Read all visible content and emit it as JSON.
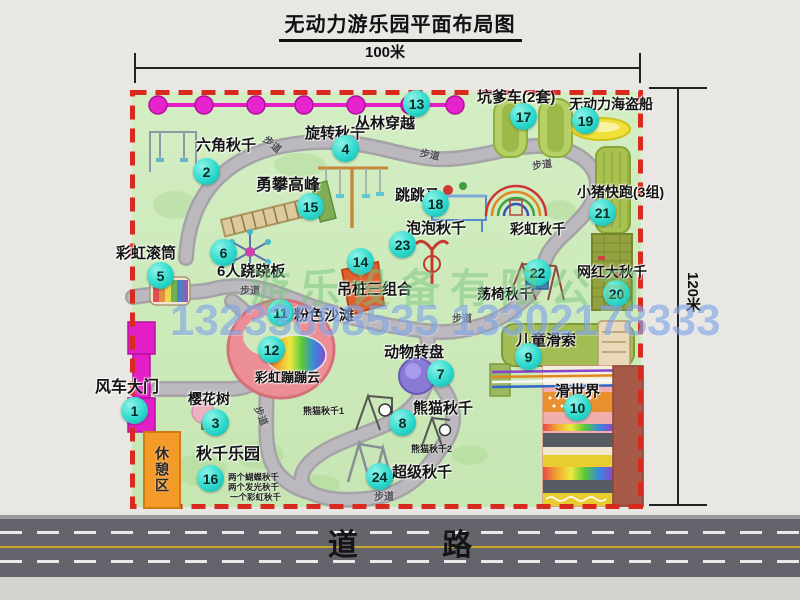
{
  "title": "无动力游乐园平面布局图",
  "dimensions": {
    "width": "100米",
    "height": "120米"
  },
  "road_label": "道 路",
  "watermark": {
    "company": "游乐设备有限公司",
    "phones": "13233808535 13302178333"
  },
  "rest_area_label": "休憩区",
  "rainbow_swing_label": "彩虹秋千",
  "panda_swing_sub1": "熊猫秋千1",
  "panda_swing_sub2": "熊猫秋千2",
  "swing_park_notes": [
    "两个蝴蝶秋千",
    "两个发光秋千",
    "一个彩虹秋千"
  ],
  "path_label": "步道",
  "path_labels": [
    {
      "x": 263,
      "y": 136,
      "rot": 40
    },
    {
      "x": 420,
      "y": 146,
      "rot": 12
    },
    {
      "x": 532,
      "y": 156,
      "rot": -8
    },
    {
      "x": 240,
      "y": 282,
      "rot": 0
    },
    {
      "x": 452,
      "y": 310,
      "rot": 0
    },
    {
      "x": 252,
      "y": 408,
      "rot": 68
    },
    {
      "x": 374,
      "y": 488,
      "rot": 0
    }
  ],
  "attractions": [
    {
      "num": "1",
      "label": "风车大门",
      "badge": [
        135,
        411
      ],
      "label_pos": [
        95,
        380
      ],
      "size": 16
    },
    {
      "num": "2",
      "label": "六角秋千",
      "badge": [
        207,
        172
      ],
      "label_pos": [
        196,
        138
      ],
      "size": 15
    },
    {
      "num": "3",
      "label": "樱花树",
      "badge": [
        216,
        423
      ],
      "label_pos": [
        188,
        392
      ],
      "size": 14
    },
    {
      "num": "4",
      "label": "旋转秋千",
      "badge": [
        346,
        149
      ],
      "label_pos": [
        305,
        126
      ],
      "size": 15
    },
    {
      "num": "5",
      "label": "彩虹滚筒",
      "badge": [
        161,
        276
      ],
      "label_pos": [
        116,
        246
      ],
      "size": 15
    },
    {
      "num": "6",
      "label": "6人跷跷板",
      "badge": [
        224,
        253
      ],
      "label_pos": [
        217,
        264
      ],
      "size": 15
    },
    {
      "num": "7",
      "label": "动物转盘",
      "badge": [
        441,
        374
      ],
      "label_pos": [
        384,
        345
      ],
      "size": 15
    },
    {
      "num": "8",
      "label": "熊猫秋千",
      "badge": [
        403,
        423
      ],
      "label_pos": [
        413,
        401
      ],
      "size": 15
    },
    {
      "num": "9",
      "label": "儿童滑索",
      "badge": [
        529,
        357
      ],
      "label_pos": [
        516,
        333
      ],
      "size": 15
    },
    {
      "num": "10",
      "label": "滑世界",
      "badge": [
        578,
        408
      ],
      "label_pos": [
        555,
        384
      ],
      "size": 15
    },
    {
      "num": "11",
      "label": "粉色沙滩",
      "badge": [
        281,
        313
      ],
      "label_pos": [
        294,
        308
      ],
      "size": 15
    },
    {
      "num": "12",
      "label": "彩虹蹦蹦云",
      "badge": [
        272,
        350
      ],
      "label_pos": [
        255,
        371
      ],
      "size": 13
    },
    {
      "num": "13",
      "label": "丛林穿越",
      "badge": [
        417,
        104
      ],
      "label_pos": [
        355,
        116
      ],
      "size": 15
    },
    {
      "num": "14",
      "label": "吊桩三组合",
      "badge": [
        361,
        262
      ],
      "label_pos": [
        337,
        282
      ],
      "size": 15
    },
    {
      "num": "15",
      "label": "勇攀高峰",
      "badge": [
        311,
        207
      ],
      "label_pos": [
        256,
        178
      ],
      "size": 16
    },
    {
      "num": "16",
      "label": "秋千乐园",
      "badge": [
        211,
        479
      ],
      "label_pos": [
        196,
        447
      ],
      "size": 16
    },
    {
      "num": "17",
      "label": "坑爹车(2套)",
      "badge": [
        524,
        117
      ],
      "label_pos": [
        477,
        90
      ],
      "size": 15
    },
    {
      "num": "18",
      "label": "跳跳马",
      "badge": [
        436,
        204
      ],
      "label_pos": [
        395,
        188
      ],
      "size": 15
    },
    {
      "num": "19",
      "label": "无动力海盗船",
      "badge": [
        586,
        121
      ],
      "label_pos": [
        569,
        97
      ],
      "size": 14
    },
    {
      "num": "20",
      "label": "网红大秋千",
      "badge": [
        617,
        294
      ],
      "label_pos": [
        577,
        265
      ],
      "size": 14
    },
    {
      "num": "21",
      "label": "小猪快跑(3组)",
      "badge": [
        603,
        213
      ],
      "label_pos": [
        577,
        185
      ],
      "size": 14
    },
    {
      "num": "22",
      "label": "荡椅秋千",
      "badge": [
        538,
        273
      ],
      "label_pos": [
        477,
        287
      ],
      "size": 14
    },
    {
      "num": "23",
      "label": "泡泡秋千",
      "badge": [
        403,
        245
      ],
      "label_pos": [
        406,
        221
      ],
      "size": 15
    },
    {
      "num": "24",
      "label": "超级秋千",
      "badge": [
        380,
        477
      ],
      "label_pos": [
        392,
        465
      ],
      "size": 15
    }
  ]
}
